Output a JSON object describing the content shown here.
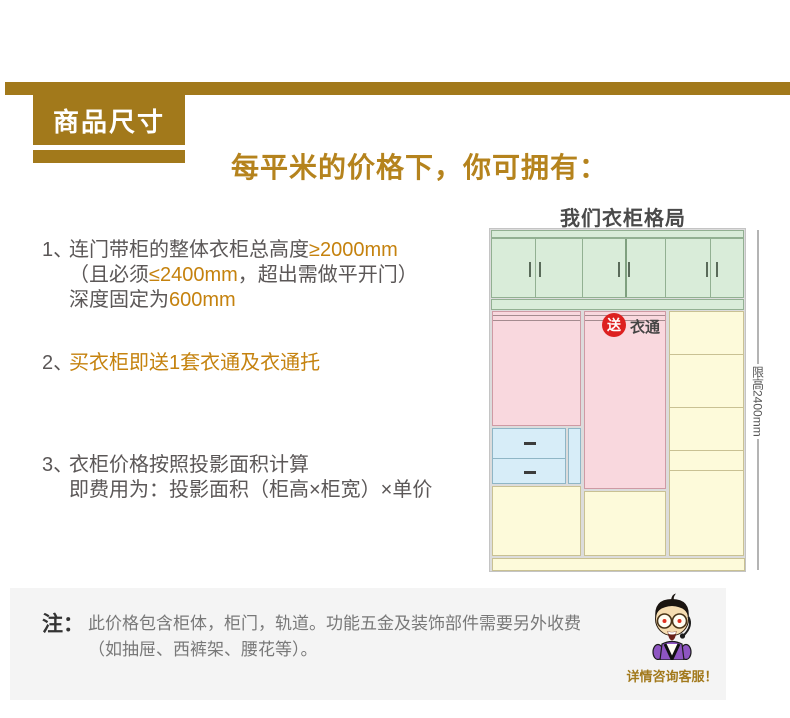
{
  "header": {
    "badge": "商品尺寸",
    "title": "每平米的价格下，你可拥有："
  },
  "features": [
    {
      "num": "1、",
      "lines": [
        {
          "pre": "连门带柜的整体衣柜总高度",
          "hl": "≥2000mm",
          "post": ""
        },
        {
          "pre": "（且必须",
          "hl": "≤2400mm",
          "post": "，超出需做平开门）"
        },
        {
          "pre": "深度固定为",
          "hl": "600mm",
          "post": ""
        }
      ]
    },
    {
      "num": "2、",
      "lines": [
        {
          "pre": "",
          "hl": "买衣柜即送1套衣通及衣通托",
          "post": ""
        }
      ]
    },
    {
      "num": "3、",
      "lines": [
        {
          "pre": "衣柜价格按照投影面积计算",
          "hl": "",
          "post": ""
        },
        {
          "pre": "即费用为：投影面积（柜高×柜宽）×单价",
          "hl": "",
          "post": ""
        }
      ]
    }
  ],
  "diagram": {
    "title": "我们衣柜格局",
    "gift_badge": "送",
    "gift_label": "衣通",
    "height_limit": "限高2400mm"
  },
  "note": {
    "prefix": "注：",
    "line1": "此价格包含柜体，柜门，轨道。功能五金及装饰部件需要另外收费",
    "line2": "（如抽屉、西裤架、腰花等）。",
    "service_caption": "详情咨询客服！"
  },
  "colors": {
    "accent_gold": "#a2791b",
    "title_gold": "#b5831d",
    "highlight_orange": "#c5820e",
    "body_gray": "#5b5757",
    "cabinet_green": "#d9ecd9",
    "hanging_pink": "#f9d8de",
    "shelf_yellow": "#fdfada",
    "drawer_blue": "#d7edf8",
    "badge_red": "#dd2020"
  }
}
